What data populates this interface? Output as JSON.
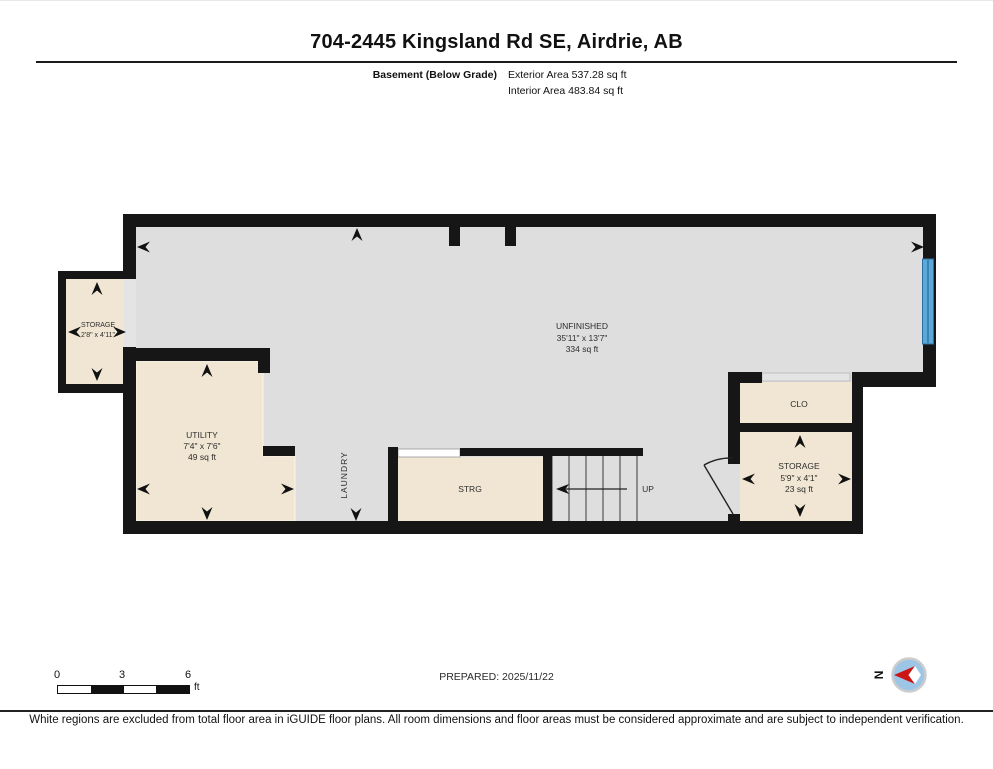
{
  "header": {
    "title": "704-2445 Kingsland Rd SE, Airdrie, AB",
    "floor_label": "Basement (Below Grade)",
    "exterior_area": "Exterior Area 537.28 sq ft",
    "interior_area": "Interior Area 483.84 sq ft"
  },
  "plan": {
    "rooms": {
      "storage_left": {
        "name": "STORAGE",
        "dims": "2'8\" x 4'11\""
      },
      "utility": {
        "name": "UTILITY",
        "dims": "7'4\" x 7'6\"",
        "area": "49 sq ft"
      },
      "unfinished": {
        "name": "UNFINISHED",
        "dims": "35'11\" x 13'7\"",
        "area": "334 sq ft"
      },
      "laundry": {
        "name": "LAUNDRY"
      },
      "strg": {
        "name": "STRG"
      },
      "stairs": {
        "direction_label": "UP"
      },
      "clo": {
        "name": "CLO"
      },
      "storage_right": {
        "name": "STORAGE",
        "dims": "5'9\" x 4'1\"",
        "area": "23 sq ft"
      }
    }
  },
  "scale_bar": {
    "tick_0": "0",
    "tick_3": "3",
    "tick_6": "6",
    "unit": "ft"
  },
  "footer": {
    "prepared": "PREPARED: 2025/11/22",
    "compass_letter": "N",
    "disclaimer": "White regions are excluded from total floor area in iGUIDE floor plans. All room dimensions and floor areas must be considered approximate and are subject to independent verification."
  },
  "colors": {
    "wall": "#161616",
    "floor_gray": "#dedede",
    "room_beige": "#f0e6d3",
    "opening_gray": "#e4e4e4",
    "window_blue": "#5aa9d8",
    "window_blue_dark": "#2e6f9f",
    "compass_red": "#cc1616",
    "compass_fill": "#9dc6e6",
    "compass_ring": "#cccccc"
  }
}
